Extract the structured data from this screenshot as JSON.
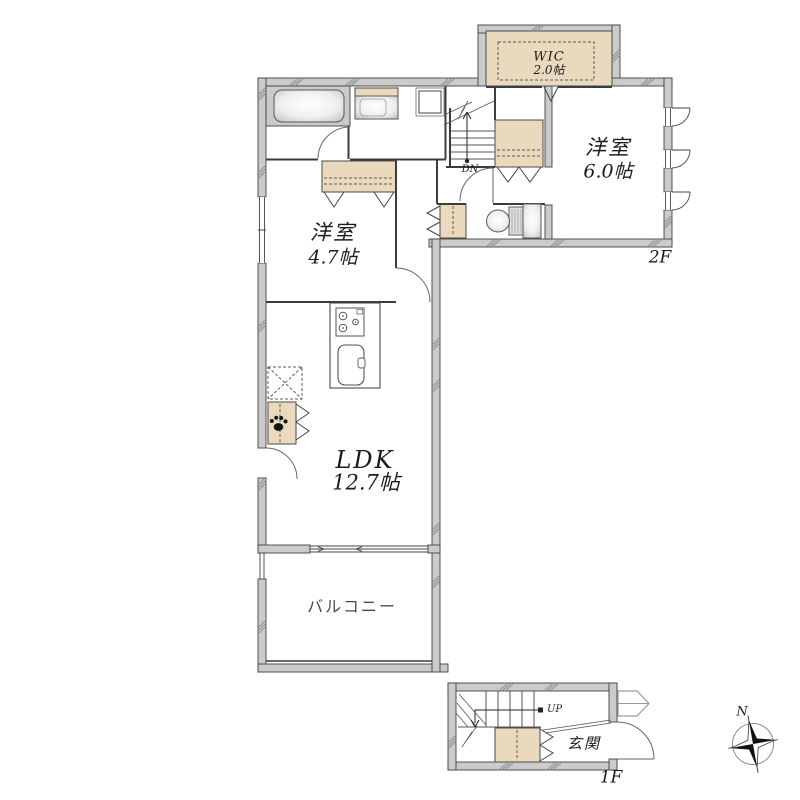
{
  "floor_plan": {
    "floors": [
      {
        "label": "2F",
        "rooms": [
          {
            "id": "wic",
            "name": "WIC",
            "size": "2.0帖"
          },
          {
            "id": "bedroom-6",
            "name": "洋室",
            "size": "6.0帖"
          },
          {
            "id": "bedroom-47",
            "name": "洋室",
            "size": "4.7帖"
          },
          {
            "id": "ldk",
            "name": "LDK",
            "size": "12.7帖"
          },
          {
            "id": "balcony",
            "name": "バルコニー"
          }
        ],
        "annotations": {
          "stairs_down": "DN"
        }
      },
      {
        "label": "1F",
        "rooms": [
          {
            "id": "genkan",
            "name": "玄関"
          }
        ],
        "annotations": {
          "stairs_up": "UP"
        }
      }
    ],
    "compass": {
      "north_label": "N"
    },
    "colors": {
      "wall": "#cbcbcb",
      "closet": "#ead9bd",
      "bath_unit": "#c9c9c9",
      "line": "#3c3c3c"
    }
  }
}
